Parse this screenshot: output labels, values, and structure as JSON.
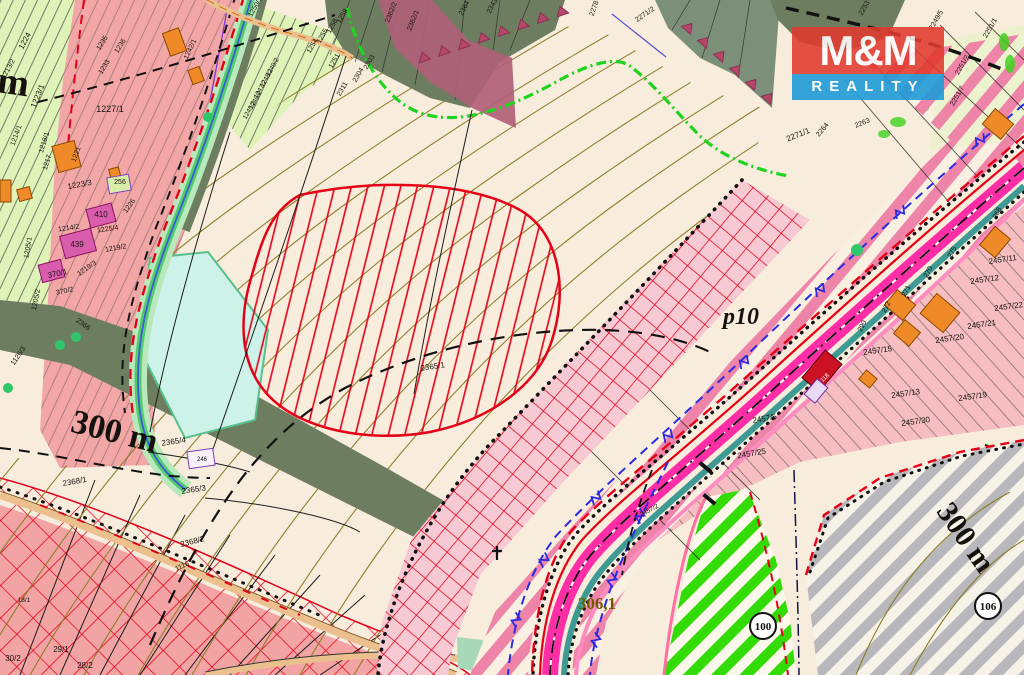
{
  "logo": {
    "top": "M&M",
    "bottom": "REALITY",
    "red": "#e23a2e",
    "blue": "#1f9cd7"
  },
  "colors": {
    "field_cream": "#f8ecdc",
    "residential_pink": "#f2a6a6",
    "parcel_green": "#dff2b8",
    "forest_green": "#6d7d60",
    "corridor_stripe_pink": "#ee84a8",
    "hatch_red": "#e2001a",
    "road_magenta": "#ff2da6",
    "reserve_gray": "#b7b7bc",
    "greenway_green": "#33dc07",
    "contour_olive": "#8b7b24",
    "water_cyan": "#cdf2e9",
    "trail_green": "#1ed41e",
    "utility_blue": "#2b2be2",
    "boundary_red": "#e60016"
  },
  "circled_labels": [
    {
      "t": "100",
      "x": 763,
      "y": 626
    },
    {
      "t": "106",
      "x": 988,
      "y": 606
    }
  ],
  "map_labels": [
    {
      "t": "300 m",
      "x": 112,
      "y": 442,
      "s": 34,
      "r": 14,
      "f": "serif",
      "w": 700
    },
    {
      "t": "300 m",
      "x": 958,
      "y": 543,
      "s": 30,
      "r": 55,
      "f": "serif",
      "w": 700
    },
    {
      "t": "m",
      "x": -4,
      "y": 92,
      "s": 38,
      "r": 8,
      "f": "serif",
      "w": 700,
      "a": "start"
    },
    {
      "t": "p10",
      "x": 741,
      "y": 324,
      "s": 24,
      "f": "serif",
      "w": 700,
      "i": true
    },
    {
      "t": "306,1",
      "x": 597,
      "y": 609,
      "s": 17,
      "f": "serif",
      "w": 700,
      "c": "#6e5c00"
    },
    {
      "t": "1224",
      "x": 27,
      "y": 42,
      "r": -62
    },
    {
      "t": "1213/2",
      "x": 10,
      "y": 70,
      "r": -62,
      "s": 7
    },
    {
      "t": "1223/1",
      "x": 40,
      "y": 97,
      "r": -68
    },
    {
      "t": "1227/1",
      "x": 110,
      "y": 112,
      "s": 9
    },
    {
      "t": "1235",
      "x": 104,
      "y": 44,
      "r": -58,
      "s": 7
    },
    {
      "t": "1236",
      "x": 122,
      "y": 47,
      "r": -58,
      "s": 7
    },
    {
      "t": "1233",
      "x": 106,
      "y": 68,
      "r": -58,
      "s": 7
    },
    {
      "t": "1214/1",
      "x": 18,
      "y": 136,
      "r": -70,
      "s": 7
    },
    {
      "t": "1218/1",
      "x": 46,
      "y": 143,
      "r": -72,
      "s": 7
    },
    {
      "t": "1217",
      "x": 49,
      "y": 163,
      "r": -72,
      "s": 7
    },
    {
      "t": "1221",
      "x": 78,
      "y": 155,
      "r": -70,
      "s": 7
    },
    {
      "t": "1223/3",
      "x": 80,
      "y": 187,
      "r": -10
    },
    {
      "t": "256",
      "x": 120,
      "y": 184,
      "s": 7
    },
    {
      "t": "1205/1",
      "x": 30,
      "y": 248,
      "r": -80,
      "s": 7
    },
    {
      "t": "1205/2",
      "x": 38,
      "y": 300,
      "r": -78,
      "s": 7
    },
    {
      "t": "370/1",
      "x": 58,
      "y": 276,
      "r": -12
    },
    {
      "t": "370/2",
      "x": 65,
      "y": 293,
      "r": -12,
      "s": 7
    },
    {
      "t": "439",
      "x": 77,
      "y": 247
    },
    {
      "t": "410",
      "x": 101,
      "y": 217
    },
    {
      "t": "1214/2",
      "x": 69,
      "y": 230,
      "r": -8,
      "s": 7
    },
    {
      "t": "1225/4",
      "x": 108,
      "y": 231,
      "r": -8,
      "s": 7
    },
    {
      "t": "1219/2",
      "x": 116,
      "y": 250,
      "r": -10,
      "s": 7
    },
    {
      "t": "1219/3",
      "x": 88,
      "y": 270,
      "r": -35,
      "s": 7
    },
    {
      "t": "1226",
      "x": 131,
      "y": 207,
      "r": -55,
      "s": 7
    },
    {
      "t": "246",
      "x": 202,
      "y": 461,
      "s": 6
    },
    {
      "t": "1242/1",
      "x": 192,
      "y": 50,
      "r": -65,
      "s": 7
    },
    {
      "t": "1250/1",
      "x": 257,
      "y": 8,
      "r": -60,
      "s": 7
    },
    {
      "t": "2366",
      "x": 82,
      "y": 326,
      "r": 35,
      "s": 7
    },
    {
      "t": "1126/3",
      "x": 20,
      "y": 357,
      "r": -55,
      "s": 7
    },
    {
      "t": "1259",
      "x": 344,
      "y": 17,
      "r": -60,
      "s": 7
    },
    {
      "t": "1258",
      "x": 334,
      "y": 27,
      "r": -60,
      "s": 7
    },
    {
      "t": "1255",
      "x": 324,
      "y": 37,
      "r": -60,
      "s": 7
    },
    {
      "t": "1254",
      "x": 314,
      "y": 47,
      "r": -60,
      "s": 7
    },
    {
      "t": "1251",
      "x": 336,
      "y": 62,
      "r": -60,
      "s": 7
    },
    {
      "t": "1249/2",
      "x": 274,
      "y": 68,
      "r": -60,
      "s": 6.5
    },
    {
      "t": "1248/2",
      "x": 268,
      "y": 79,
      "r": -60,
      "s": 6.5
    },
    {
      "t": "1247/2",
      "x": 262,
      "y": 90,
      "r": -60,
      "s": 6.5
    },
    {
      "t": "1246/2",
      "x": 257,
      "y": 101,
      "r": -60,
      "s": 6.5
    },
    {
      "t": "1245/2",
      "x": 251,
      "y": 111,
      "r": -60,
      "s": 6.5
    },
    {
      "t": "2303",
      "x": 371,
      "y": 63,
      "r": -60,
      "s": 7
    },
    {
      "t": "2304",
      "x": 360,
      "y": 76,
      "r": -60,
      "s": 7
    },
    {
      "t": "2311",
      "x": 344,
      "y": 90,
      "r": -60,
      "s": 7
    },
    {
      "t": "2362/2",
      "x": 393,
      "y": 13,
      "r": -68,
      "s": 7
    },
    {
      "t": "2362/1",
      "x": 415,
      "y": 21,
      "r": -68,
      "s": 7
    },
    {
      "t": "2364",
      "x": 466,
      "y": 9,
      "r": -62,
      "s": 7
    },
    {
      "t": "2343",
      "x": 494,
      "y": 7,
      "r": -62,
      "s": 7
    },
    {
      "t": "2278",
      "x": 596,
      "y": 9,
      "r": -70,
      "s": 7
    },
    {
      "t": "2271/2",
      "x": 646,
      "y": 16,
      "r": -35,
      "s": 7
    },
    {
      "t": "2271/1",
      "x": 799,
      "y": 137,
      "r": -22
    },
    {
      "t": "2264",
      "x": 824,
      "y": 131,
      "r": -50,
      "s": 7
    },
    {
      "t": "2263",
      "x": 863,
      "y": 125,
      "r": -22,
      "s": 7
    },
    {
      "t": "2253",
      "x": 866,
      "y": 9,
      "r": -60,
      "s": 7
    },
    {
      "t": "2249/5",
      "x": 938,
      "y": 21,
      "r": -60,
      "s": 7
    },
    {
      "t": "2251/1",
      "x": 992,
      "y": 29,
      "r": -60,
      "s": 7
    },
    {
      "t": "2251/2",
      "x": 964,
      "y": 66,
      "r": -60,
      "s": 7
    },
    {
      "t": "2251/7",
      "x": 959,
      "y": 97,
      "r": -60,
      "s": 7
    },
    {
      "t": "290",
      "x": 864,
      "y": 327,
      "r": -62,
      "s": 7
    },
    {
      "t": "272",
      "x": 888,
      "y": 308,
      "r": -62,
      "s": 7
    },
    {
      "t": "271",
      "x": 908,
      "y": 292,
      "r": -62,
      "s": 7
    },
    {
      "t": "270",
      "x": 930,
      "y": 273,
      "r": -62,
      "s": 7
    },
    {
      "t": "275",
      "x": 954,
      "y": 253,
      "r": -62,
      "s": 7
    },
    {
      "t": "268",
      "x": 999,
      "y": 214,
      "r": -62,
      "s": 7
    },
    {
      "t": "118",
      "x": 826,
      "y": 379,
      "r": -45,
      "s": 6,
      "c": "#ffffff"
    },
    {
      "t": "2457/11",
      "x": 1003,
      "y": 262,
      "r": -8
    },
    {
      "t": "2457/12",
      "x": 985,
      "y": 282,
      "r": -8
    },
    {
      "t": "2457/22",
      "x": 1009,
      "y": 309,
      "r": -8
    },
    {
      "t": "2457/21",
      "x": 982,
      "y": 327,
      "r": -8
    },
    {
      "t": "2457/20",
      "x": 950,
      "y": 341,
      "r": -8
    },
    {
      "t": "2457/15",
      "x": 878,
      "y": 353,
      "r": -8
    },
    {
      "t": "2457/13",
      "x": 906,
      "y": 396,
      "r": -8
    },
    {
      "t": "2457/19",
      "x": 973,
      "y": 399,
      "r": -8
    },
    {
      "t": "2457/30",
      "x": 916,
      "y": 424,
      "r": -8
    },
    {
      "t": "2457/5",
      "x": 765,
      "y": 421,
      "r": -10
    },
    {
      "t": "2457/25",
      "x": 752,
      "y": 456,
      "r": -10
    },
    {
      "t": "2457/2",
      "x": 650,
      "y": 512,
      "r": -28,
      "s": 6.5
    },
    {
      "t": "2365/1",
      "x": 433,
      "y": 369,
      "r": -8
    },
    {
      "t": "2365/4",
      "x": 174,
      "y": 444,
      "r": -8
    },
    {
      "t": "2368/1",
      "x": 75,
      "y": 484,
      "r": -10
    },
    {
      "t": "2365/3",
      "x": 194,
      "y": 492,
      "r": -8
    },
    {
      "t": "2368/2",
      "x": 193,
      "y": 544,
      "r": -14
    },
    {
      "t": "1116",
      "x": 183,
      "y": 568,
      "r": -24,
      "s": 7
    },
    {
      "t": "18/1",
      "x": 24,
      "y": 602,
      "s": 6.5
    },
    {
      "t": "29/1",
      "x": 61,
      "y": 652
    },
    {
      "t": "30/2",
      "x": 13,
      "y": 661
    },
    {
      "t": "28/2",
      "x": 85,
      "y": 668
    }
  ]
}
